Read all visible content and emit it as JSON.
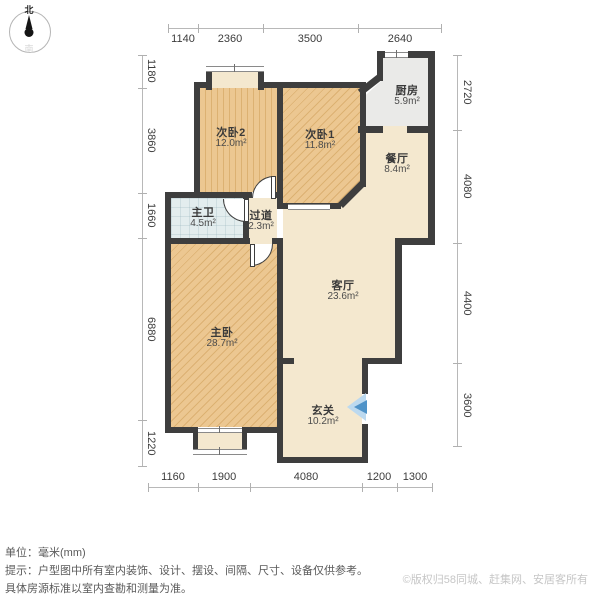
{
  "compass": {
    "north": "北",
    "south": "南"
  },
  "rooms": {
    "bedroom2": {
      "name": "次卧2",
      "area": "12.0m²"
    },
    "bedroom1": {
      "name": "次卧1",
      "area": "11.8m²"
    },
    "kitchen": {
      "name": "厨房",
      "area": "5.9m²"
    },
    "dining": {
      "name": "餐厅",
      "area": "8.4m²"
    },
    "bathroom": {
      "name": "主卫",
      "area": "4.5m²"
    },
    "hallway": {
      "name": "过道",
      "area": "2.3m²"
    },
    "living": {
      "name": "客厅",
      "area": "23.6m²"
    },
    "master": {
      "name": "主卧",
      "area": "28.7m²"
    },
    "entry": {
      "name": "玄关",
      "area": "10.2m²"
    }
  },
  "dimensions": {
    "unit": "mm",
    "top": [
      "1140",
      "2360",
      "3500",
      "2640"
    ],
    "bottom": [
      "1160",
      "1900",
      "4080",
      "1200",
      "1300"
    ],
    "left": [
      "1180",
      "3860",
      "1660",
      "6880",
      "1220"
    ],
    "right": [
      "2720",
      "4080",
      "4400",
      "3600"
    ]
  },
  "footer": {
    "unit_label": "单位：毫米(mm)",
    "tip_line1": "提示：户型图中所有室内装饰、设计、摆设、间隔、尺寸、设备仅供参考。",
    "tip_line2": "具体房源标准以室内查勘和测量为准。",
    "copyright": "©版权归58同城、赶集网、安居客所有"
  },
  "colors": {
    "wall": "#3e3e3e",
    "wood_floor": "#ecc791",
    "wood_stripe": "#dcb172",
    "public_floor": "#f4e8cf",
    "kitchen_tile": "#eaeae8",
    "bath_tile": "#e3edee",
    "entry_arrow_light": "#bcd9ef",
    "entry_arrow_dark": "#4f93c8"
  }
}
